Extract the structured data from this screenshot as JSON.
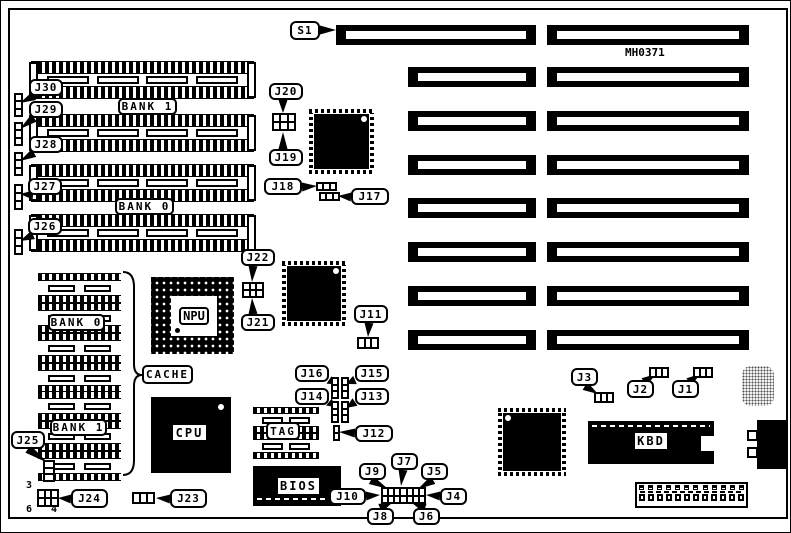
{
  "figure": {
    "part_number": "MH0371"
  },
  "texts": [
    {
      "id": "part-number",
      "text": "MH0371",
      "x": 624,
      "y": 45,
      "size": 11
    },
    {
      "id": "j24-pin-3",
      "text": "3",
      "x": 25,
      "y": 479,
      "size": 10
    },
    {
      "id": "j24-pin-6",
      "text": "6",
      "x": 25,
      "y": 503,
      "size": 10
    },
    {
      "id": "j24-pin-4",
      "text": "4",
      "x": 50,
      "y": 503,
      "size": 10
    }
  ],
  "callouts": [
    {
      "id": "s1",
      "text": "S1",
      "x": 289,
      "y": 20,
      "w": 30,
      "h": 19,
      "tail": [
        319,
        29,
        335,
        29
      ]
    },
    {
      "id": "j30",
      "text": "J30",
      "x": 28,
      "y": 78,
      "w": 34,
      "h": 17,
      "tail": [
        33,
        95,
        19,
        102
      ]
    },
    {
      "id": "j29",
      "text": "J29",
      "x": 28,
      "y": 100,
      "w": 34,
      "h": 17,
      "tail": [
        33,
        117,
        19,
        128
      ]
    },
    {
      "id": "j28",
      "text": "J28",
      "x": 28,
      "y": 135,
      "w": 34,
      "h": 17,
      "tail": [
        33,
        152,
        19,
        160
      ]
    },
    {
      "id": "j27",
      "text": "J27",
      "x": 27,
      "y": 177,
      "w": 34,
      "h": 17,
      "tail": [
        32,
        194,
        19,
        193
      ]
    },
    {
      "id": "j26",
      "text": "J26",
      "x": 27,
      "y": 217,
      "w": 34,
      "h": 17,
      "tail": [
        32,
        234,
        19,
        240
      ]
    },
    {
      "id": "j25",
      "text": "J25",
      "x": 10,
      "y": 430,
      "w": 34,
      "h": 18,
      "tail": [
        27,
        448,
        47,
        462
      ]
    },
    {
      "id": "j24",
      "text": "J24",
      "x": 70,
      "y": 488,
      "w": 37,
      "h": 19,
      "tail": [
        70,
        498,
        57,
        497
      ]
    },
    {
      "id": "j23",
      "text": "J23",
      "x": 169,
      "y": 488,
      "w": 37,
      "h": 19,
      "tail": [
        169,
        498,
        155,
        497
      ]
    },
    {
      "id": "j22",
      "text": "J22",
      "x": 240,
      "y": 248,
      "w": 34,
      "h": 17,
      "tail": [
        252,
        265,
        251,
        281
      ]
    },
    {
      "id": "j21",
      "text": "J21",
      "x": 240,
      "y": 313,
      "w": 34,
      "h": 17,
      "tail": [
        252,
        313,
        251,
        297
      ]
    },
    {
      "id": "j20",
      "text": "J20",
      "x": 268,
      "y": 82,
      "w": 34,
      "h": 17,
      "tail": [
        282,
        99,
        282,
        112
      ]
    },
    {
      "id": "j19",
      "text": "J19",
      "x": 268,
      "y": 148,
      "w": 34,
      "h": 17,
      "tail": [
        282,
        148,
        282,
        131
      ]
    },
    {
      "id": "j18",
      "text": "J18",
      "x": 263,
      "y": 177,
      "w": 38,
      "h": 17,
      "tail": [
        301,
        186,
        316,
        185
      ]
    },
    {
      "id": "j17",
      "text": "J17",
      "x": 350,
      "y": 187,
      "w": 38,
      "h": 17,
      "tail": [
        350,
        196,
        337,
        195
      ]
    },
    {
      "id": "j11",
      "text": "J11",
      "x": 353,
      "y": 304,
      "w": 34,
      "h": 18,
      "tail": [
        368,
        322,
        367,
        336
      ]
    },
    {
      "id": "j16",
      "text": "J16",
      "x": 294,
      "y": 364,
      "w": 34,
      "h": 17,
      "tail": [
        328,
        379,
        334,
        383
      ]
    },
    {
      "id": "j15",
      "text": "J15",
      "x": 354,
      "y": 364,
      "w": 34,
      "h": 17,
      "tail": [
        354,
        379,
        345,
        383
      ]
    },
    {
      "id": "j14",
      "text": "J14",
      "x": 294,
      "y": 387,
      "w": 34,
      "h": 17,
      "tail": [
        328,
        401,
        334,
        406
      ]
    },
    {
      "id": "j13",
      "text": "J13",
      "x": 354,
      "y": 387,
      "w": 34,
      "h": 17,
      "tail": [
        354,
        401,
        345,
        407
      ]
    },
    {
      "id": "j12",
      "text": "J12",
      "x": 354,
      "y": 424,
      "w": 38,
      "h": 17,
      "tail": [
        354,
        432,
        338,
        431
      ]
    },
    {
      "id": "j10",
      "text": "J10",
      "x": 328,
      "y": 487,
      "w": 37,
      "h": 17,
      "tail": [
        365,
        495,
        379,
        494
      ]
    },
    {
      "id": "j9",
      "text": "J9",
      "x": 358,
      "y": 462,
      "w": 27,
      "h": 17,
      "tail": [
        370,
        479,
        387,
        488
      ]
    },
    {
      "id": "j7",
      "text": "J7",
      "x": 390,
      "y": 452,
      "w": 27,
      "h": 17,
      "tail": [
        402,
        469,
        400,
        485
      ]
    },
    {
      "id": "j5",
      "text": "J5",
      "x": 420,
      "y": 462,
      "w": 27,
      "h": 17,
      "tail": [
        432,
        479,
        417,
        488
      ]
    },
    {
      "id": "j4",
      "text": "J4",
      "x": 439,
      "y": 487,
      "w": 27,
      "h": 17,
      "tail": [
        439,
        495,
        425,
        494
      ]
    },
    {
      "id": "j8",
      "text": "J8",
      "x": 366,
      "y": 507,
      "w": 27,
      "h": 17,
      "tail": [
        379,
        507,
        391,
        502
      ]
    },
    {
      "id": "j6",
      "text": "J6",
      "x": 412,
      "y": 507,
      "w": 27,
      "h": 17,
      "tail": [
        424,
        507,
        411,
        502
      ]
    },
    {
      "id": "j3",
      "text": "J3",
      "x": 570,
      "y": 367,
      "w": 27,
      "h": 18,
      "tail": [
        584,
        385,
        597,
        393
      ]
    },
    {
      "id": "j2",
      "text": "J2",
      "x": 626,
      "y": 379,
      "w": 27,
      "h": 18,
      "tail": [
        643,
        381,
        655,
        373
      ]
    },
    {
      "id": "j1",
      "text": "J1",
      "x": 671,
      "y": 379,
      "w": 27,
      "h": 18,
      "tail": [
        688,
        381,
        699,
        373
      ]
    }
  ],
  "boxed_labels": [
    {
      "id": "bank1-simm",
      "text": "BANK 1",
      "x": 117,
      "y": 97,
      "w": 59,
      "h": 17
    },
    {
      "id": "bank0-simm",
      "text": "BANK 0",
      "x": 114,
      "y": 197,
      "w": 59,
      "h": 17
    },
    {
      "id": "bank0-cache",
      "text": "BANK 0",
      "x": 47,
      "y": 313,
      "w": 57,
      "h": 17
    },
    {
      "id": "bank1-cache",
      "text": "BANK 1",
      "x": 49,
      "y": 418,
      "w": 57,
      "h": 17
    },
    {
      "id": "cache",
      "text": "CACHE",
      "x": 141,
      "y": 364,
      "w": 51,
      "h": 19
    },
    {
      "id": "tag",
      "text": "TAG",
      "x": 265,
      "y": 421,
      "w": 34,
      "h": 18
    }
  ],
  "chip_labels": [
    {
      "id": "cpu-label",
      "text": "CPU",
      "x": 172,
      "y": 424,
      "w": 33,
      "h": 15
    },
    {
      "id": "bios-label",
      "text": "BIOS",
      "x": 277,
      "y": 477,
      "w": 41,
      "h": 16
    },
    {
      "id": "kbd-label",
      "text": "KBD",
      "x": 634,
      "y": 432,
      "w": 32,
      "h": 16
    }
  ],
  "components": {
    "cpu": {
      "label": "CPU",
      "x": 150,
      "y": 396,
      "w": 80,
      "h": 76
    },
    "npu": {
      "label": "NPU",
      "x": 150,
      "y": 276,
      "w": 83,
      "h": 77
    },
    "bios": {
      "x": 252,
      "y": 465,
      "w": 88,
      "h": 40
    },
    "kbd": {
      "x": 587,
      "y": 420,
      "w": 126,
      "h": 43
    },
    "power": {
      "x": 634,
      "y": 481,
      "w": 113,
      "h": 26,
      "pins": 12
    },
    "din": {
      "x": 756,
      "y": 419,
      "w": 31,
      "h": 49
    },
    "crystal": {
      "x": 741,
      "y": 365,
      "w": 32,
      "h": 40
    }
  },
  "chips": [
    {
      "id": "chipset-1",
      "x": 308,
      "y": 108,
      "w": 65,
      "h": 65,
      "dot": "tr"
    },
    {
      "id": "chipset-2",
      "x": 281,
      "y": 260,
      "w": 64,
      "h": 65,
      "dot": "tr"
    },
    {
      "id": "chipset-3",
      "x": 497,
      "y": 407,
      "w": 68,
      "h": 68,
      "dot": "tl"
    }
  ],
  "slots": [
    {
      "x": 335,
      "y": 24,
      "w": 200,
      "h": 20
    },
    {
      "x": 546,
      "y": 24,
      "w": 202,
      "h": 20
    },
    {
      "x": 407,
      "y": 66,
      "w": 128,
      "h": 20
    },
    {
      "x": 546,
      "y": 66,
      "w": 202,
      "h": 20
    },
    {
      "x": 407,
      "y": 110,
      "w": 128,
      "h": 20
    },
    {
      "x": 546,
      "y": 110,
      "w": 202,
      "h": 20
    },
    {
      "x": 407,
      "y": 154,
      "w": 128,
      "h": 20
    },
    {
      "x": 546,
      "y": 154,
      "w": 202,
      "h": 20
    },
    {
      "x": 407,
      "y": 197,
      "w": 128,
      "h": 20
    },
    {
      "x": 546,
      "y": 197,
      "w": 202,
      "h": 20
    },
    {
      "x": 407,
      "y": 241,
      "w": 128,
      "h": 20
    },
    {
      "x": 546,
      "y": 241,
      "w": 202,
      "h": 20
    },
    {
      "x": 407,
      "y": 285,
      "w": 128,
      "h": 20
    },
    {
      "x": 546,
      "y": 285,
      "w": 202,
      "h": 20
    },
    {
      "x": 407,
      "y": 329,
      "w": 128,
      "h": 20
    },
    {
      "x": 546,
      "y": 329,
      "w": 202,
      "h": 20
    }
  ],
  "simms": [
    {
      "x": 30,
      "y": 60,
      "w": 223,
      "h": 38
    },
    {
      "x": 30,
      "y": 113,
      "w": 223,
      "h": 38
    },
    {
      "x": 30,
      "y": 163,
      "w": 223,
      "h": 38
    },
    {
      "x": 30,
      "y": 213,
      "w": 223,
      "h": 38
    }
  ],
  "dips": [
    {
      "x": 37,
      "y": 272,
      "w": 83,
      "h": 30
    },
    {
      "x": 37,
      "y": 302,
      "w": 83,
      "h": 30
    },
    {
      "x": 37,
      "y": 332,
      "w": 83,
      "h": 30
    },
    {
      "x": 37,
      "y": 362,
      "w": 83,
      "h": 30
    },
    {
      "x": 37,
      "y": 390,
      "w": 83,
      "h": 30
    },
    {
      "x": 37,
      "y": 420,
      "w": 83,
      "h": 30
    },
    {
      "x": 37,
      "y": 450,
      "w": 83,
      "h": 30
    },
    {
      "x": 252,
      "y": 406,
      "w": 66,
      "h": 26
    },
    {
      "x": 252,
      "y": 432,
      "w": 66,
      "h": 26
    }
  ],
  "jumpers": [
    {
      "id": "j30-header",
      "x": 13,
      "y": 92,
      "w": 9,
      "h": 24,
      "cols": 1,
      "rows": 3
    },
    {
      "id": "j29-header",
      "x": 13,
      "y": 121,
      "w": 9,
      "h": 24,
      "cols": 1,
      "rows": 3
    },
    {
      "id": "j28-header",
      "x": 13,
      "y": 151,
      "w": 9,
      "h": 24,
      "cols": 1,
      "rows": 3
    },
    {
      "id": "j27-header",
      "x": 13,
      "y": 183,
      "w": 9,
      "h": 26,
      "cols": 1,
      "rows": 3
    },
    {
      "id": "j26-header",
      "x": 13,
      "y": 228,
      "w": 9,
      "h": 26,
      "cols": 1,
      "rows": 3
    },
    {
      "id": "j25-header",
      "x": 42,
      "y": 459,
      "w": 12,
      "h": 22,
      "cols": 1,
      "rows": 3
    },
    {
      "id": "j24-header",
      "x": 36,
      "y": 488,
      "w": 22,
      "h": 18,
      "cols": 3,
      "rows": 2
    },
    {
      "id": "j23-header",
      "x": 131,
      "y": 491,
      "w": 23,
      "h": 12,
      "cols": 3,
      "rows": 1
    },
    {
      "id": "j22-header",
      "x": 241,
      "y": 281,
      "w": 22,
      "h": 16,
      "cols": 3,
      "rows": 2
    },
    {
      "id": "j20-header",
      "x": 271,
      "y": 112,
      "w": 24,
      "h": 18,
      "cols": 3,
      "rows": 2
    },
    {
      "id": "j18-header",
      "x": 315,
      "y": 181,
      "w": 21,
      "h": 9,
      "cols": 3,
      "rows": 1
    },
    {
      "id": "j17-header",
      "x": 318,
      "y": 191,
      "w": 21,
      "h": 9,
      "cols": 3,
      "rows": 1
    },
    {
      "id": "j11-header",
      "x": 356,
      "y": 336,
      "w": 22,
      "h": 12,
      "cols": 3,
      "rows": 1
    },
    {
      "id": "j16-header",
      "x": 330,
      "y": 376,
      "w": 8,
      "h": 22,
      "cols": 1,
      "rows": 3
    },
    {
      "id": "j15-header",
      "x": 340,
      "y": 376,
      "w": 8,
      "h": 22,
      "cols": 1,
      "rows": 3
    },
    {
      "id": "j14-header",
      "x": 330,
      "y": 400,
      "w": 8,
      "h": 22,
      "cols": 1,
      "rows": 3
    },
    {
      "id": "j13-header",
      "x": 340,
      "y": 400,
      "w": 8,
      "h": 22,
      "cols": 1,
      "rows": 3
    },
    {
      "id": "j12-header",
      "x": 332,
      "y": 424,
      "w": 7,
      "h": 16,
      "cols": 1,
      "rows": 2
    },
    {
      "id": "j4-j10-block",
      "x": 380,
      "y": 486,
      "w": 45,
      "h": 17,
      "cols": 7,
      "rows": 2
    },
    {
      "id": "j3-header",
      "x": 593,
      "y": 391,
      "w": 20,
      "h": 11,
      "cols": 3,
      "rows": 1
    },
    {
      "id": "j2-header",
      "x": 648,
      "y": 366,
      "w": 20,
      "h": 11,
      "cols": 3,
      "rows": 1
    },
    {
      "id": "j1-header",
      "x": 692,
      "y": 366,
      "w": 20,
      "h": 11,
      "cols": 3,
      "rows": 1
    }
  ],
  "brace": {
    "x": 133,
    "top": 271,
    "bottom": 474,
    "tip": 374,
    "tip_x": 141
  }
}
